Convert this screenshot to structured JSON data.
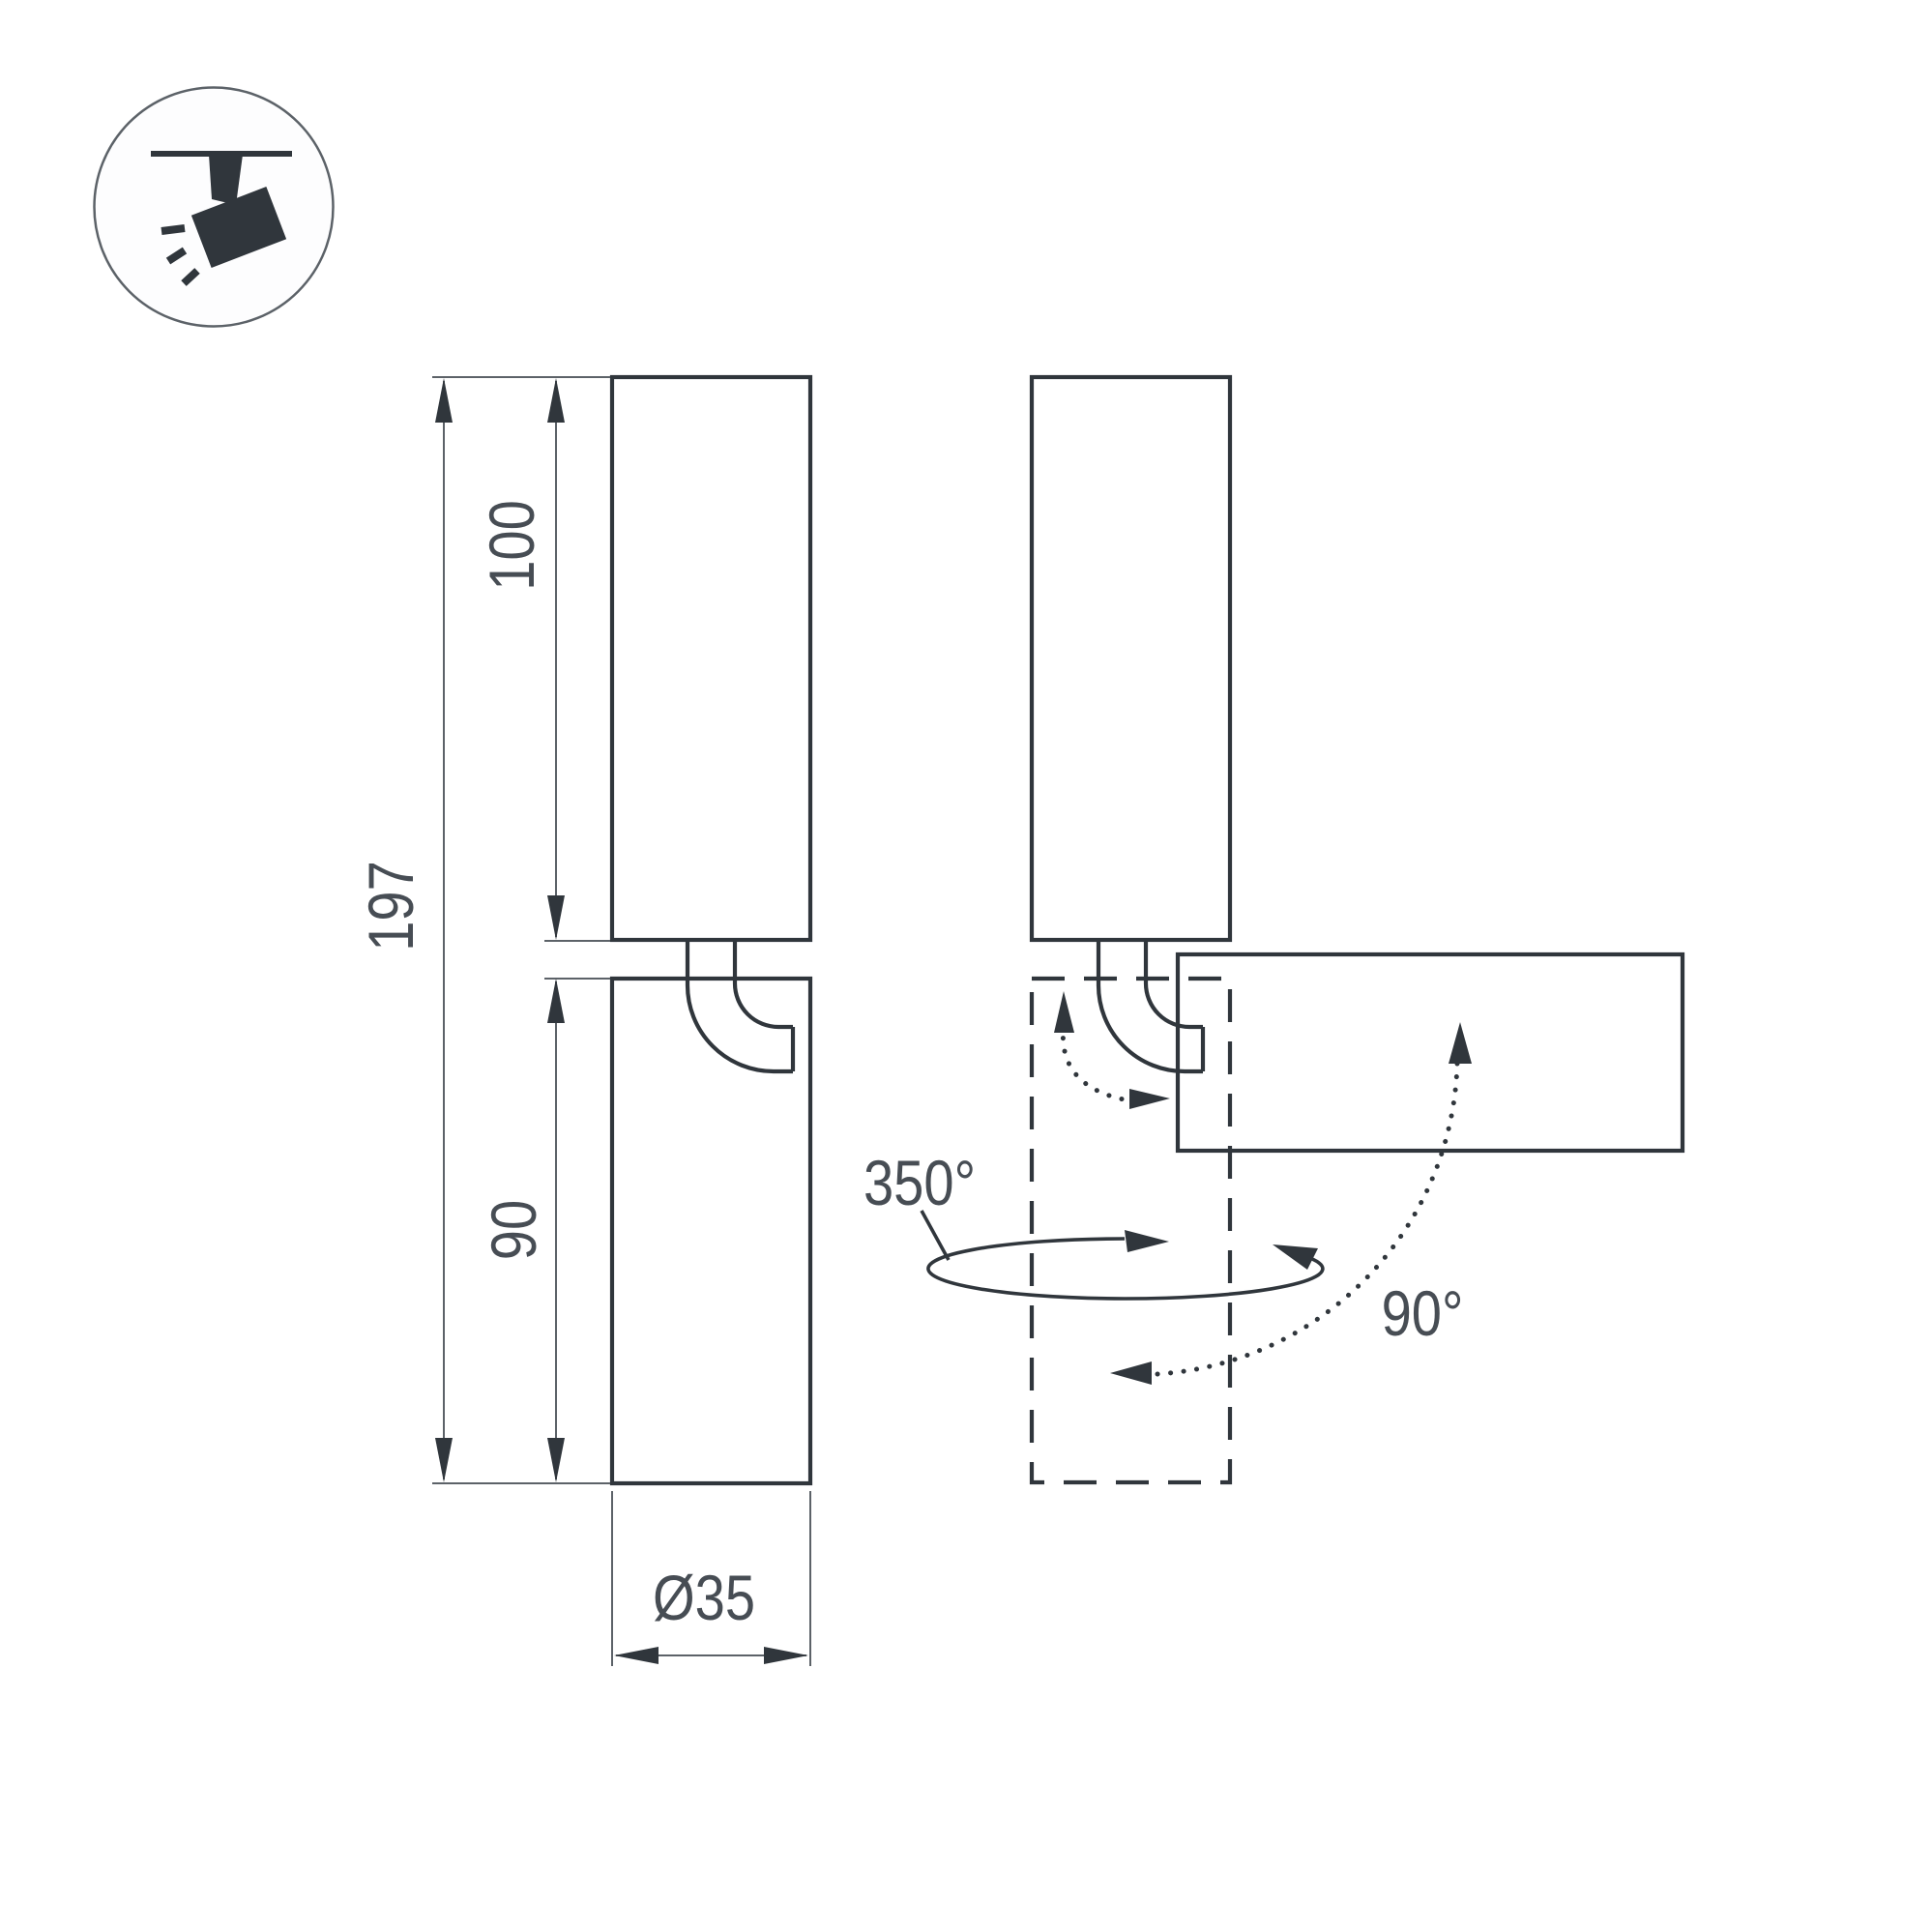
{
  "colors": {
    "ink": "#30363c",
    "dim": "#5c6268",
    "text": "#474d54",
    "background": "#ffffff"
  },
  "legend": {
    "icon": "track-spotlight-icon"
  },
  "front_view": {
    "dim_total_height": "197",
    "dim_body_height": "100",
    "dim_head_height": "90",
    "dim_diameter": "Ø35"
  },
  "rotation_view": {
    "pan_angle": "350°",
    "tilt_angle": "90°"
  }
}
